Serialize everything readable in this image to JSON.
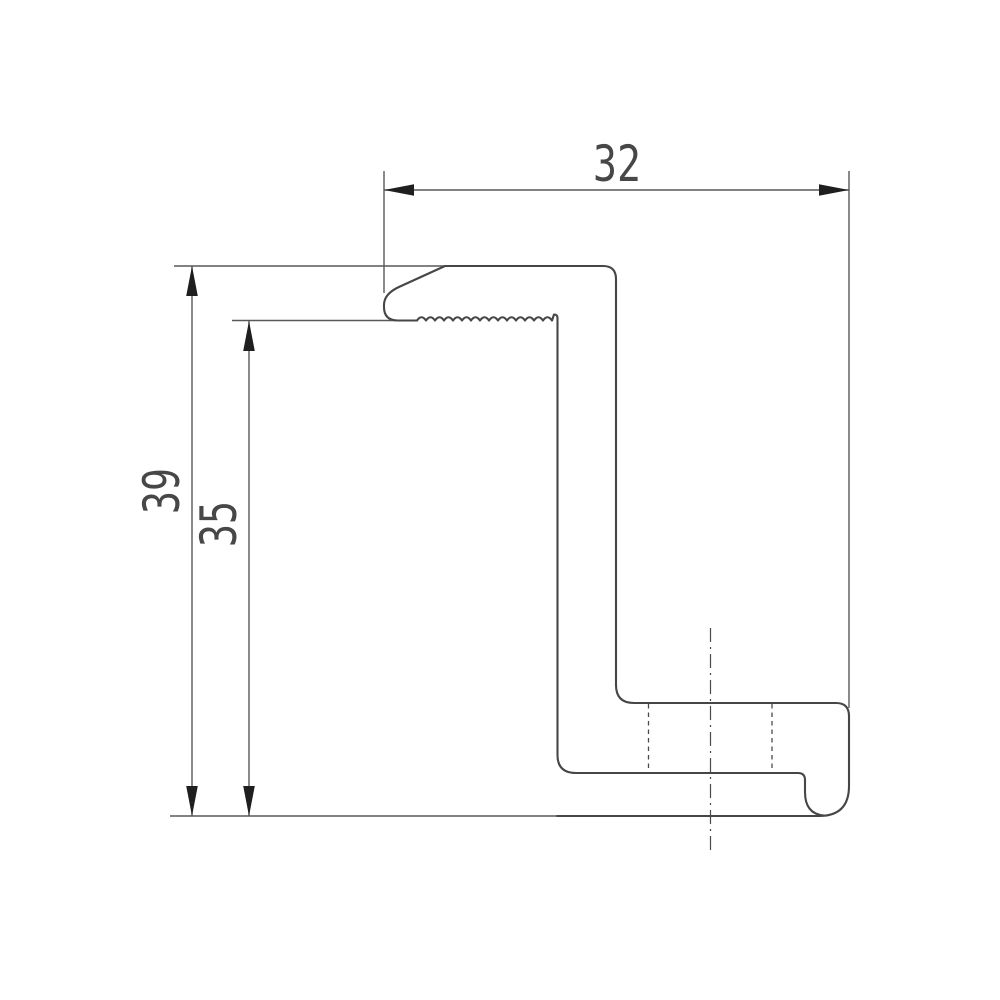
{
  "meta": {
    "type": "technical-drawing",
    "subject": "z-profile-end-clamp-cross-section"
  },
  "drawing": {
    "background": "#ffffff",
    "profile_line_color": "#464646",
    "dimension_line_color": "#585858",
    "arrow_color": "#1f1f1f",
    "text_color": "#474747",
    "hidden_line_color": "#4a4a4a",
    "center_line_color": "#4a4a4a",
    "dimensions": {
      "overall_width": {
        "value": "32"
      },
      "overall_height": {
        "value": "39"
      },
      "inner_height": {
        "value": "35"
      }
    }
  }
}
